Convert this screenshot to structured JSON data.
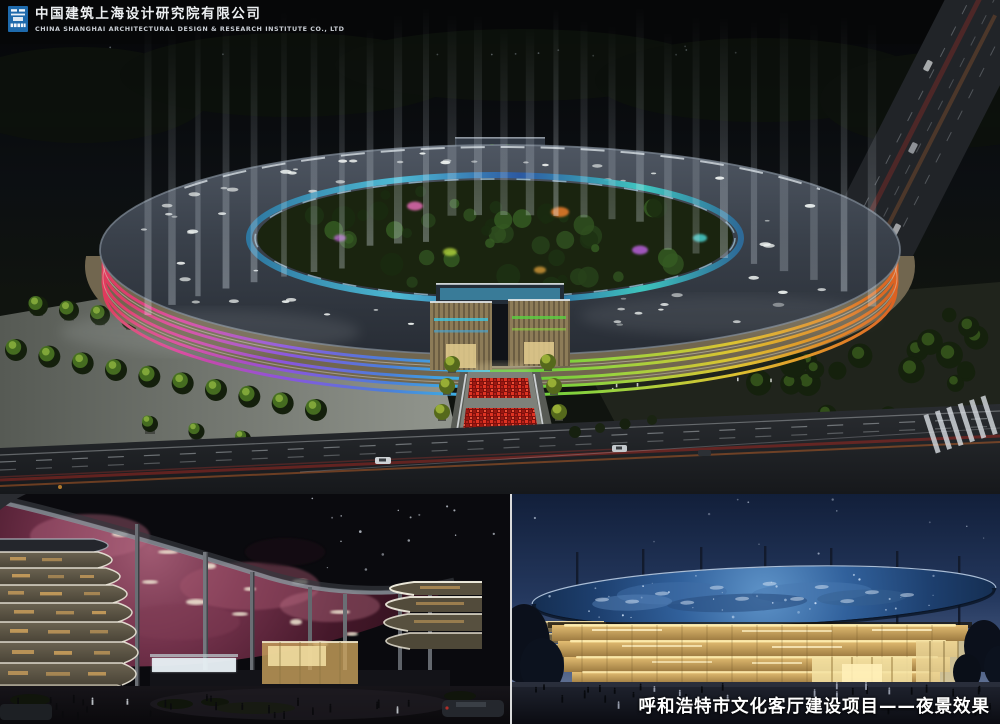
{
  "header": {
    "company_cn": "中国建筑上海设计研究院有限公司",
    "company_en": "CHINA SHANGHAI ARCHITECTURAL DESIGN & RESEARCH INSTITUTE CO., LTD",
    "logo_color": "#1e6aac"
  },
  "caption": {
    "text": "呼和浩特市文化客厅建设项目——夜景效果",
    "color": "#ffffff"
  },
  "palette": {
    "night_sky": "#07090c",
    "roof_slate": "#3a414b",
    "beam_light": "#dfe8f0",
    "facade_left": [
      "#e23848",
      "#d8459e",
      "#8a55dd",
      "#4b7fd9",
      "#37c3e6"
    ],
    "facade_right": [
      "#4fc838",
      "#9ad33f",
      "#ddc231",
      "#e08426",
      "#db5f22"
    ],
    "glass_ring": "#4fc3de",
    "red_plaza": "#c42418",
    "tree_green": "#4e7a24",
    "nebula_canopy": "#6e2f44",
    "starry_canopy": "#1c3a64",
    "warm_facade": "#d9b267",
    "deep_blue_sky": "#152440"
  }
}
